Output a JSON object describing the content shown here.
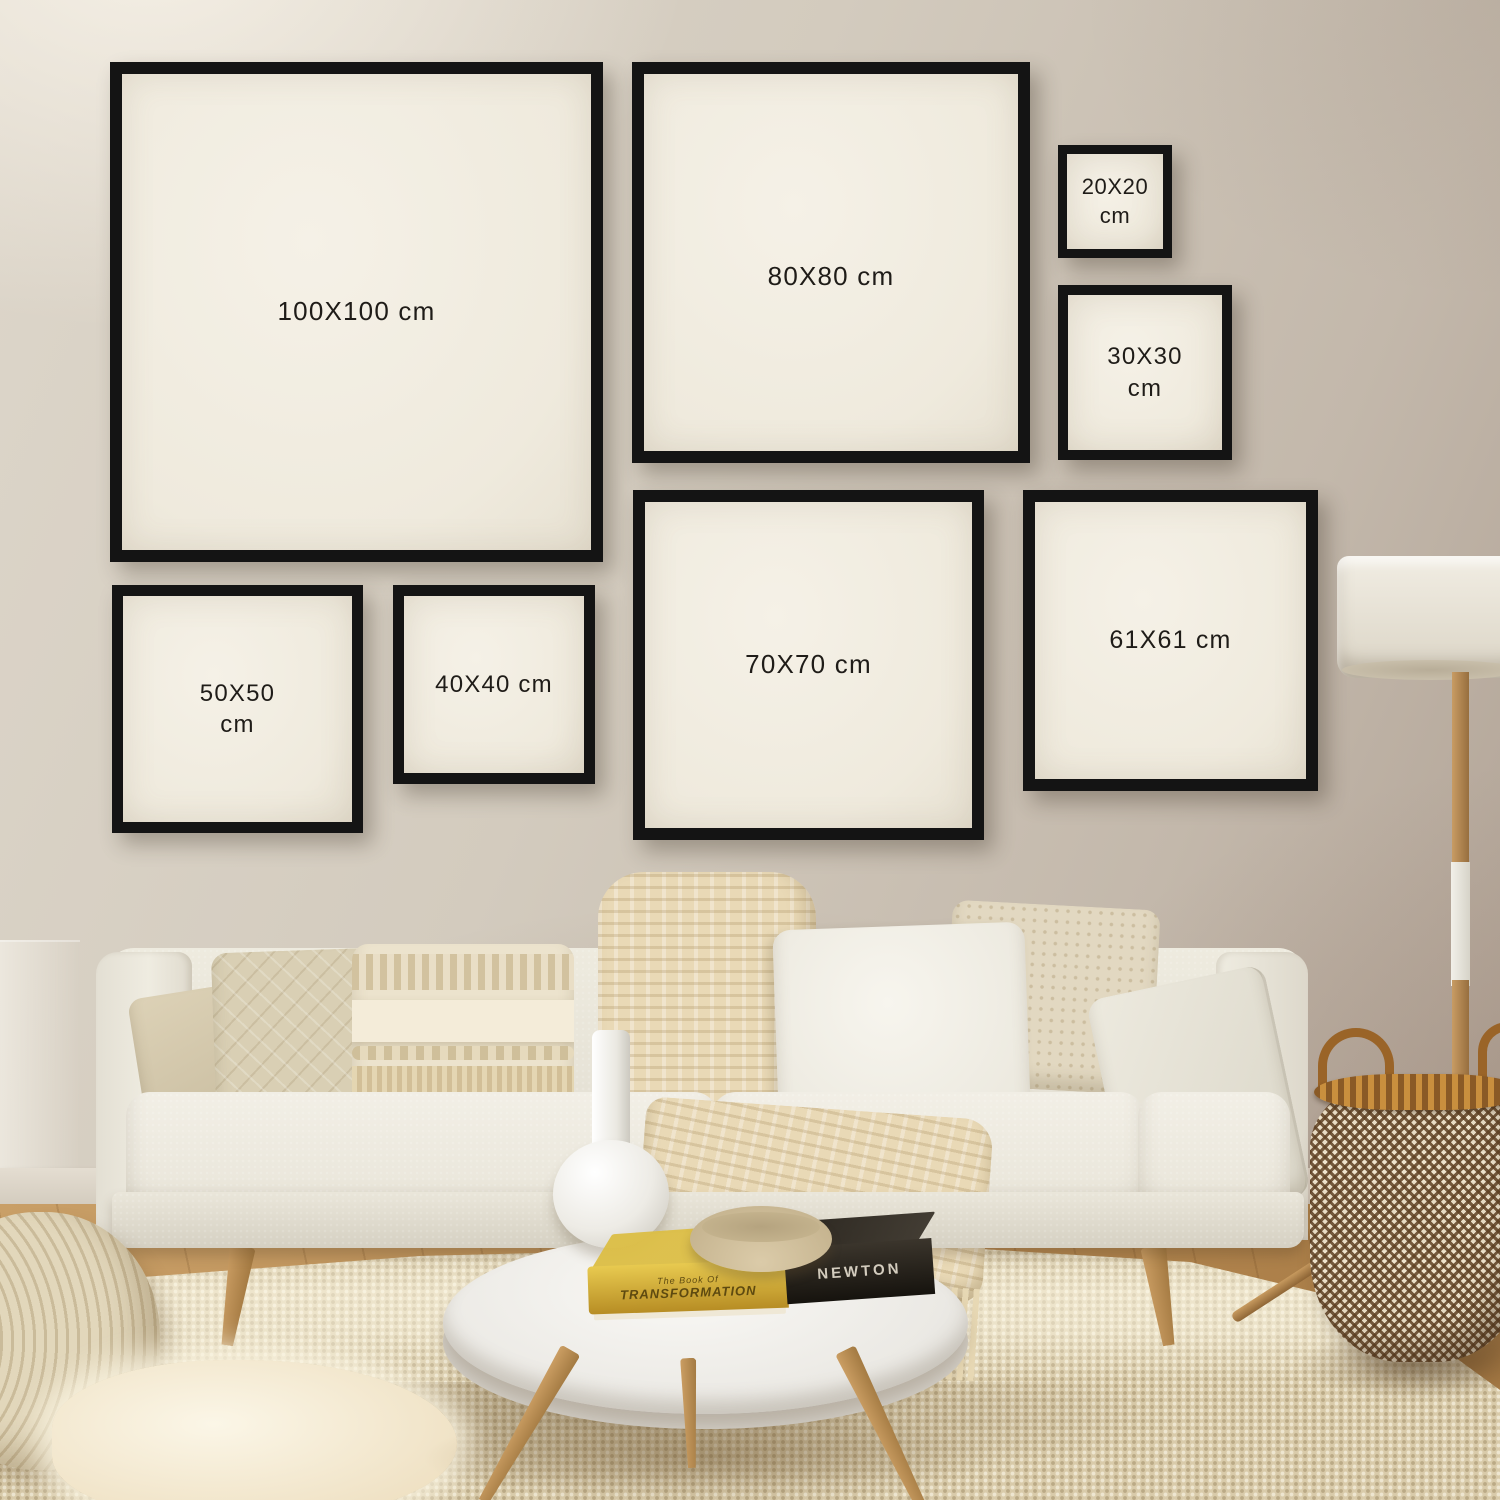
{
  "frames": [
    {
      "key": "100x100",
      "line1": "100X100 cm",
      "line2": ""
    },
    {
      "key": "80x80",
      "line1": "80X80 cm",
      "line2": ""
    },
    {
      "key": "20x20",
      "line1": "20X20",
      "line2": "cm"
    },
    {
      "key": "30x30",
      "line1": "30X30",
      "line2": "cm"
    },
    {
      "key": "50x50",
      "line1": "50X50",
      "line2": "cm"
    },
    {
      "key": "40x40",
      "line1": "40X40 cm",
      "line2": ""
    },
    {
      "key": "70x70",
      "line1": "70X70 cm",
      "line2": ""
    },
    {
      "key": "61x61",
      "line1": "61X61 cm",
      "line2": ""
    }
  ],
  "book": {
    "spine_series": "The Book Of",
    "spine_title": "TRANSFORMATION",
    "spine_name": "NEWTON"
  },
  "colors": {
    "frame_border": "#141414",
    "frame_mat": "#f0ebdf",
    "label_text": "#1f1c18",
    "wall_light": "#ddd6ca",
    "wall_dark": "#ab9c8f",
    "wood_floor": "#b2854e",
    "rug": "#d9cbaa",
    "sofa": "#e8e4d8",
    "throw": "#e9d9b6",
    "lamp_shade": "#eae5d9",
    "basket_brown": "#6d4d2e",
    "basket_cream": "#e8dcc4",
    "book_yellow": "#d9b93f"
  }
}
